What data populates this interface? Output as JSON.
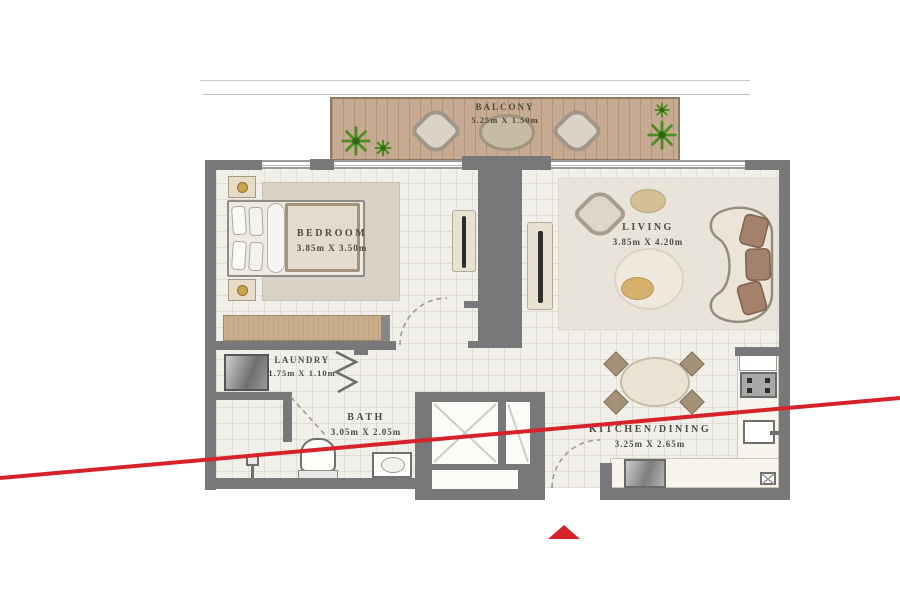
{
  "image": {
    "type": "apartment floor plan"
  },
  "rooms": [
    {
      "name": "BALCONY",
      "dimensions": "5.25m X 1.50m"
    },
    {
      "name": "BEDROOM",
      "dimensions": "3.85m X 3.50m"
    },
    {
      "name": "LIVING",
      "dimensions": "3.85m X 4.20m"
    },
    {
      "name": "LAUNDRY",
      "dimensions": "1.75m X 1.10m"
    },
    {
      "name": "BATH",
      "dimensions": "3.05m X 2.05m"
    },
    {
      "name": "KITCHEN/DINING",
      "dimensions": "3.25m X 2.65m"
    }
  ],
  "colors": {
    "wall_gray": "#78787a",
    "wood_deck": "#c6aa91",
    "floor": "#f1efe9",
    "accent_red": "#d6232b",
    "plant_green": "#4e8d26"
  },
  "annotations": {
    "red_diagonal_line": "diagonal red line crossing plan from lower-left to mid-right",
    "red_triangle_marker": "small red upward triangle below plan"
  }
}
